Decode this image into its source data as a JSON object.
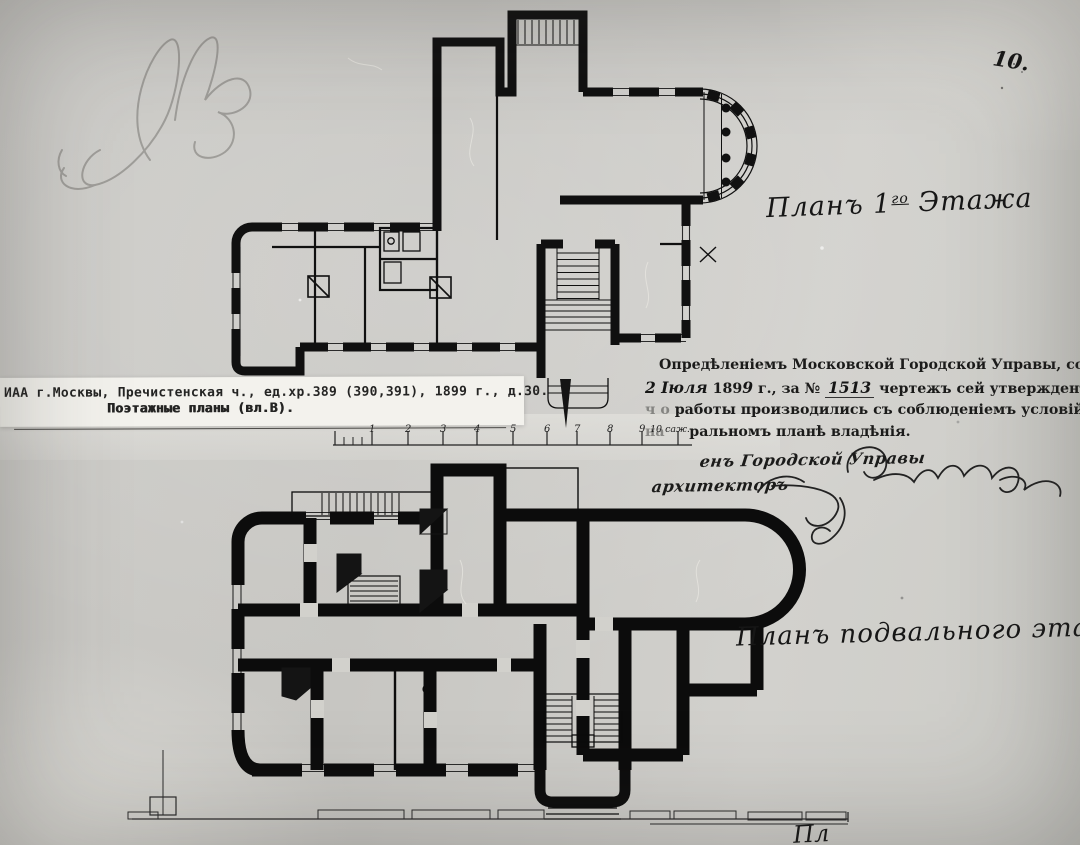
{
  "photo": {
    "page_number": "10.",
    "pencil_monogram": "АВ"
  },
  "plans": {
    "first_floor_title": {
      "prefix": "Планъ 1",
      "sup": "го",
      "suffix": " Этажа"
    },
    "basement_title": "Планъ подвального этажа",
    "bottom_cut_caption": "Пл"
  },
  "archive_label": {
    "line1": "ИАА г.Москвы, Пречистенская ч., ед.хр.389 (390,391), 1899 г., д.30.",
    "line2": "Поэтажные планы (вл.В)."
  },
  "approval_stamp": {
    "line1": "Опредѣленіемъ Московской Городской Управы, состоявшимся",
    "line2_hand_date": "2 Іюля",
    "line2_print_year": "189",
    "line2_hand_year": "9",
    "line2_print_mid": "г., за №",
    "line2_hand_number": "1513",
    "line2_print_tail": "чертежъ сей утвержденъ съ",
    "line2_bold_tail": "тѣмъ только",
    "line3_faint": "ч о",
    "line3": "работы производились съ соблюденіемъ условій,",
    "line3_bold": "значущихся",
    "line4_faint": "на",
    "line4": "ральномъ планѣ владѣнія."
  },
  "signatures": {
    "line1_label": "енъ Городской Управы",
    "line2_label": "архитекторъ"
  },
  "scale_bar": {
    "labels": [
      "1",
      "2",
      "3",
      "4",
      "5",
      "6",
      "7",
      "8",
      "9"
    ],
    "unit_label": "10 саж."
  }
}
